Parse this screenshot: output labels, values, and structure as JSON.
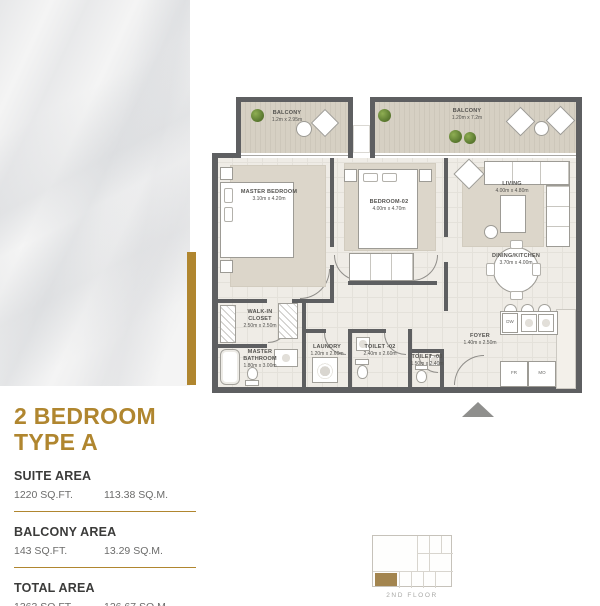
{
  "plan": {
    "balcony_a": {
      "name": "BALCONY",
      "dims": "1.2m x 2.95m"
    },
    "balcony_b": {
      "name": "BALCONY",
      "dims": "1.20m x 7.2m"
    },
    "master_bedroom": {
      "name": "MASTER BEDROOM",
      "dims": "3.10m x 4.20m"
    },
    "bedroom_02": {
      "name": "BEDROOM-02",
      "dims": "4.00m x 4.70m"
    },
    "living": {
      "name": "LIVING",
      "dims": "4.00m x 4.80m"
    },
    "dining_kitchen": {
      "name": "DINING/KITCHEN",
      "dims": "3.70m x 4.00m"
    },
    "walk_in_closet": {
      "name": "WALK-IN CLOSET",
      "dims": "2.50m x 2.50m"
    },
    "master_bathroom": {
      "name": "MASTER BATHROOM",
      "dims": "1.80m x 3.00m"
    },
    "laundry": {
      "name": "LAUNDRY",
      "dims": "1.20m x 2.60m"
    },
    "toilet_02": {
      "name": "TOILET -02",
      "dims": "2.40m x 2.60m"
    },
    "toilet_03": {
      "name": "TOILET -03",
      "dims": "1.50m x 2.40m"
    },
    "foyer": {
      "name": "FOYER",
      "dims": "1.40m x 2.50m"
    },
    "appliances": {
      "dishwasher": "DW",
      "fridge": "FR",
      "microwave": "MO"
    }
  },
  "info": {
    "title_line1": "2 BEDROOM",
    "title_line2": "TYPE A",
    "sections": [
      {
        "label": "SUITE AREA",
        "sqft": "1220 SQ.FT.",
        "sqm": "113.38 SQ.M."
      },
      {
        "label": "BALCONY AREA",
        "sqft": "143 SQ.FT.",
        "sqm": "13.29 SQ.M."
      },
      {
        "label": "TOTAL AREA",
        "sqft": "1363 SQ.FT.",
        "sqm": "126.67 SQ.M."
      }
    ]
  },
  "keyplan": {
    "floor_label": "2ND FLOOR"
  },
  "colors": {
    "gold": "#B0862F",
    "wall": "#5E5F61"
  }
}
